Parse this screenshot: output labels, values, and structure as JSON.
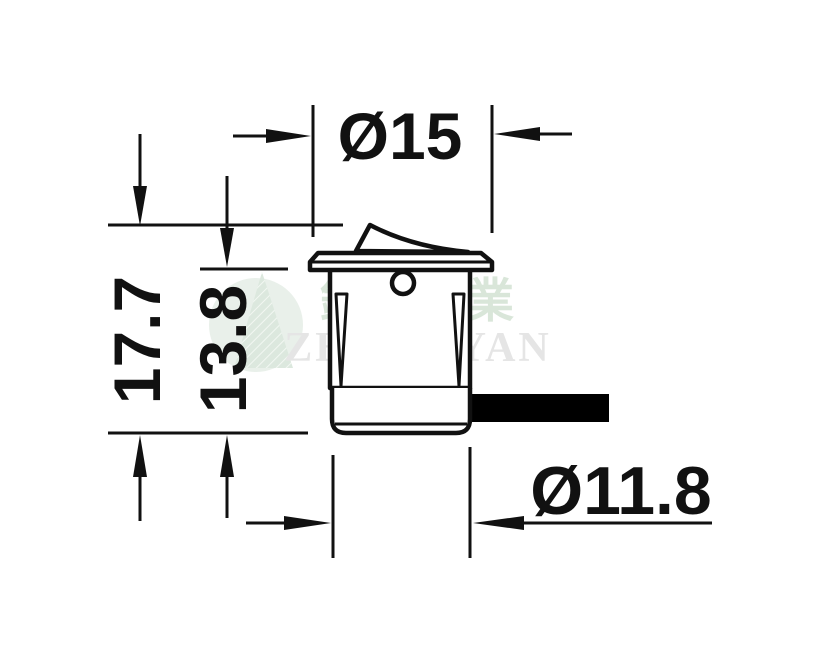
{
  "page": {
    "background": "#ffffff"
  },
  "drawing": {
    "type": "technical-dimension-drawing",
    "subject": "miniature round rocker switch, side elevation with wire lead",
    "line_color": "#111111",
    "cable_color": "#000000",
    "dimensions": {
      "top_diameter_label": "Ø15",
      "overall_height_label": "17.7",
      "body_height_label": "13.8",
      "body_diameter_label": "Ø11.8"
    },
    "watermark": {
      "cjk_text": "鐘嚴實業",
      "latin_text": "ZHONGYAN",
      "logo_circle_color": "#e9f0ea",
      "logo_triangle_color": "#dce8de",
      "logo_hatch_color": "#f2f7f2",
      "cjk_text_color": "#d9e6d9",
      "latin_text_color": "#e5e5e5"
    }
  }
}
